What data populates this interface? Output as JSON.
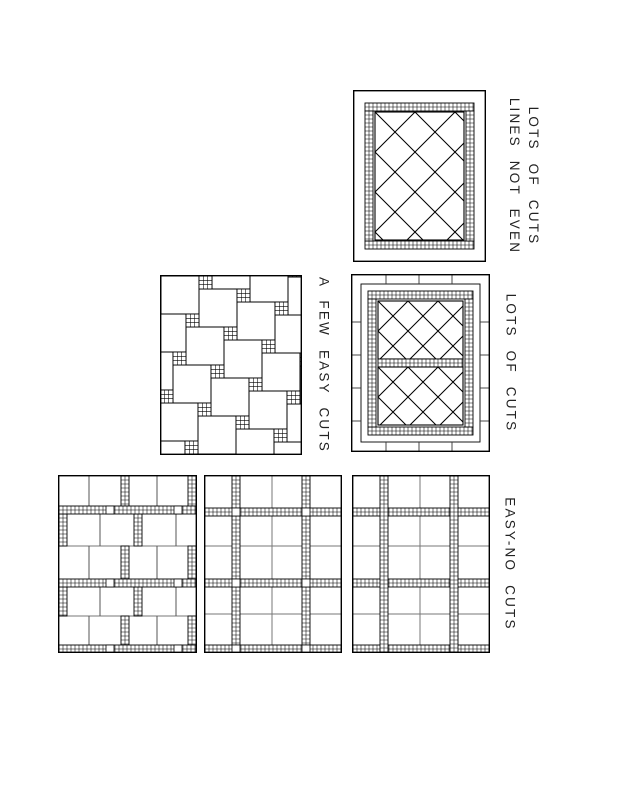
{
  "colors": {
    "ink": "#000000",
    "paper": "#ffffff"
  },
  "labels": {
    "top_right": {
      "line1": "LOTS OF CUTS",
      "line2": "LINES NOT EVEN"
    },
    "middle": {
      "text": "A FEW EASY CUTS"
    },
    "middle_right": {
      "text": "LOTS OF CUTS"
    },
    "bottom": {
      "text": "EASY-NO CUTS"
    }
  }
}
